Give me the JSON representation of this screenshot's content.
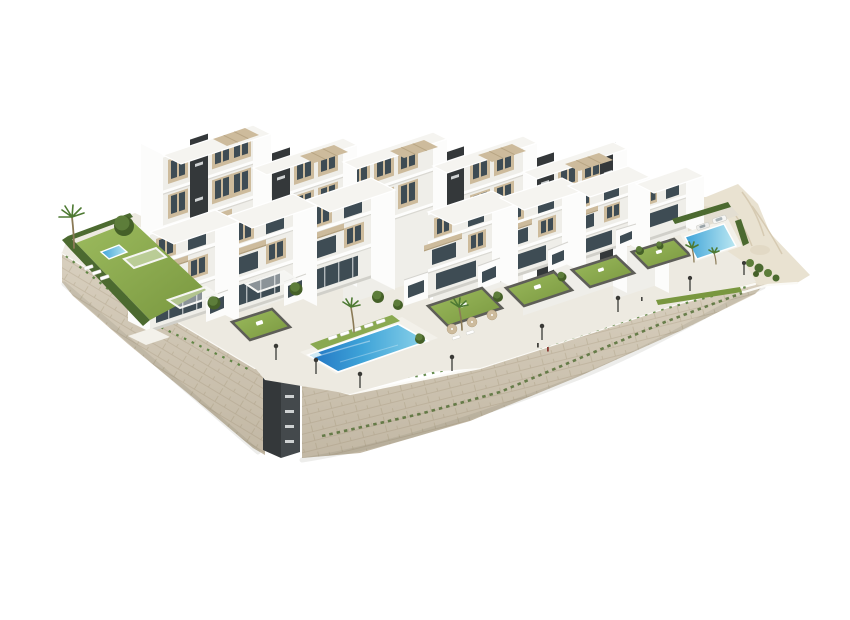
{
  "palette": {
    "bg": "#ffffff",
    "white": "#fcfcfb",
    "faceShade": "#efeee9",
    "faceDim": "#e4e3dd",
    "roof": "#f5f4f0",
    "accent": "#cdbb9c",
    "accentDark": "#b3a07e",
    "core": "#34383a",
    "coreLight": "#44494c",
    "glass": "#3e4c54",
    "glassLight": "#5d707b",
    "rail": "#d5d4cf",
    "wall": "#d8cfbe",
    "wallLine": "#c0b49d",
    "wallShade": "#8a7c62",
    "sand": "#e9e2d1",
    "sandRidge": "#d6cab2",
    "deck": "#edeae1",
    "deckLight": "#f3f1ea",
    "road": "#e3ded2",
    "coping": "#61615b",
    "lawn": "#8aa950",
    "lawnLight": "#9cbb5e",
    "lawnDark": "#79973f",
    "hedge": "#4c6a30",
    "tree": "#5d7d3a",
    "treeDark": "#456028",
    "palm": "#4e7a33",
    "poolDeep": "#2173c2",
    "poolMid": "#3ea3d8",
    "poolLight": "#8ed4ea",
    "poolPale": "#bce8f2",
    "lamp": "#3a3a36",
    "figure": "#8a3b34"
  },
  "scene": {
    "back_apartment_blocks": 6,
    "front_townhouses": 7,
    "dark_stair_cores": 6,
    "roof_pergolas": 6,
    "patio_pergolas": 3,
    "private_gardens": 6,
    "pools": {
      "main_pool": 1,
      "left_garden_pool": 1,
      "right_pool": 1
    },
    "street_lamps": 8,
    "cars": 2,
    "palm_trees": 5,
    "retaining_walls": 2,
    "sun_loungers": 10,
    "umbrellas": 3
  }
}
